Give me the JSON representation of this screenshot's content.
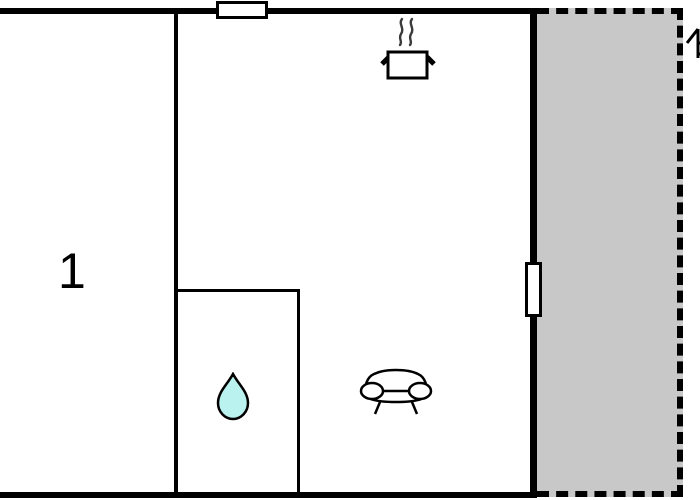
{
  "floor_plan": {
    "room_labels": {
      "room1": "1"
    },
    "colors": {
      "wall": "#000000",
      "terrace_fill": "#c8c8c8",
      "water_drop_fill": "#baf2ef",
      "steam_stroke": "#3a3a3a",
      "background": "#ffffff"
    },
    "icons": {
      "window": "window-icon",
      "door": "door-icon",
      "cooking_pot": "cooking-pot-icon",
      "steam": "steam-icon",
      "water_drop": "water-drop-icon",
      "sofa": "sofa-icon",
      "partial_number": "partial-number-1-icon"
    }
  }
}
